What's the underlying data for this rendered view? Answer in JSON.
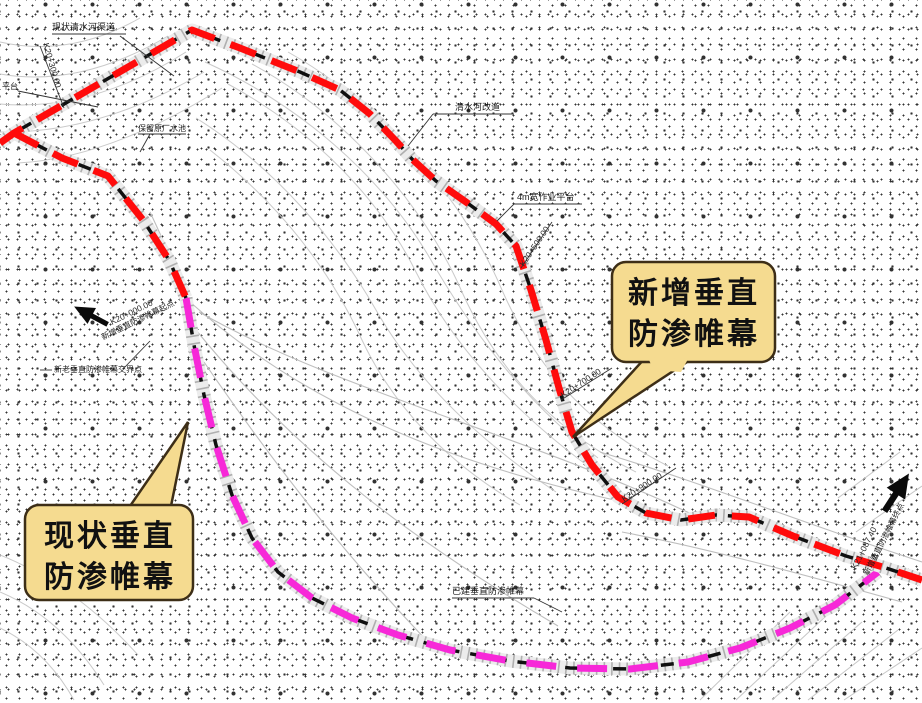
{
  "callout_new": {
    "line1": "新增垂直",
    "line2": "防渗帷幕"
  },
  "callout_existing": {
    "line1": "现状垂直",
    "line2": "防渗帷幕"
  },
  "map_labels": {
    "existing_channel": "现状清水河渠道",
    "river_diversion": "清水河改道",
    "work_platform": "4m宽作业平台",
    "keep_pond": "保留原厂水池",
    "platform_edge": "平台",
    "junction_point": "新老垂直防渗帷幕交界点",
    "built_curtain": "已建垂直防渗帷幕",
    "start_station": "K20+000.00",
    "start_point": "新增垂直防渗帷幕起点",
    "end_station": "K21+087.40",
    "end_point": "新增垂直防渗帷幕终点",
    "station_a": "K20+300.00",
    "station_b": "K20+500.00",
    "station_c": "K20+700.00",
    "station_d": "K20+900.00"
  },
  "colors": {
    "new_curtain": "#ff0b0b",
    "existing_curtain": "#f728d8",
    "callout_fill": "#f5db90",
    "callout_border": "#3d2e17"
  }
}
